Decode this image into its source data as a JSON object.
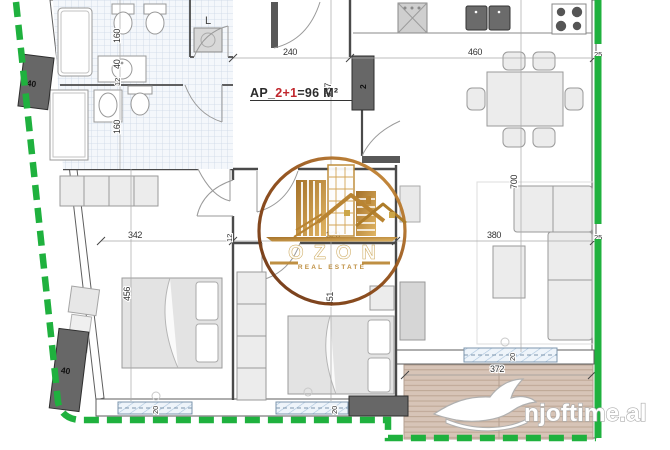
{
  "plan": {
    "ap_prefix": "AP_",
    "ap_type": "2+1",
    "ap_area": "=96 M²",
    "laundry_label": "L"
  },
  "columns": {
    "top_left": "40",
    "bottom_left": "40",
    "entry": "2"
  },
  "dimensions": {
    "hall_width": "240",
    "hall_height": "337",
    "kitchen_width": "460",
    "wall_right_top": "25",
    "wall_right_mid": "25",
    "bath_top": "160",
    "bath_wall": "40",
    "bath_gap": "12",
    "bath_bottom": "160",
    "bedroom1_width": "342",
    "bedroom1_wall": "12",
    "bedroom1_height": "456",
    "corridor_width": "320",
    "bedroom2_height": "451",
    "living_height": "700",
    "living_width": "380",
    "terrace_width": "372",
    "window_bedroom1": "20",
    "window_bedroom2": "20",
    "window_living": "20"
  },
  "logo": {
    "brand": "OZON",
    "tagline": "REAL ESTATE"
  },
  "watermark": {
    "site": "njoftime.al"
  },
  "colors": {
    "boundary_green": "#1fb13e",
    "accent_red": "#c1272d",
    "gold": "#bc8a38",
    "column_gray": "#676767"
  }
}
